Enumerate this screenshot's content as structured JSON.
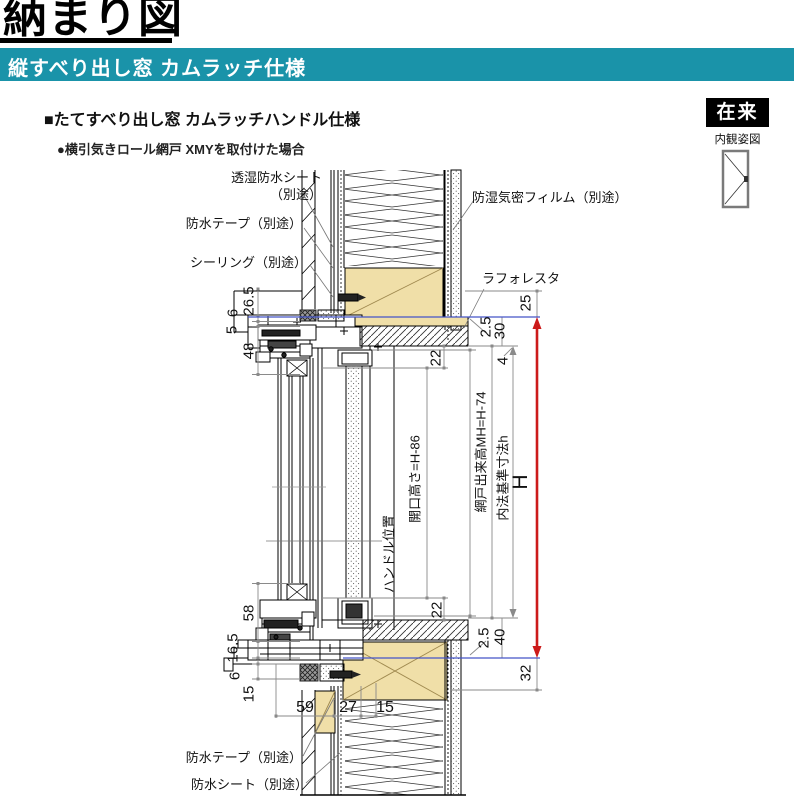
{
  "page": {
    "title": "納まり図",
    "band_title": "縦すべり出し窓 カムラッチ仕様",
    "section_heading": "■たてすべり出し窓 カムラッチハンドル仕様",
    "condition_note": "●横引気きロール網戸 XMYを取付けた場合",
    "construction_badge": "在来",
    "view_caption": "内観姿図"
  },
  "colors": {
    "band_teal": "#1a93a9",
    "wood_fill": "#f0dfa8",
    "reference_blue": "#4353c8",
    "dimension_red": "#cc1a1a"
  },
  "callouts": {
    "breathable_sheet": "透湿防水シート\n（別途）",
    "waterproof_tape_top": "防水テープ（別途）",
    "sealing": "シーリング（別途）",
    "vapor_film": "防湿気密フィルム（別途）",
    "laforesta": "ラフォレスタ",
    "waterproof_tape_bottom": "防水テープ（別途）",
    "waterproof_sheet_bottom": "防水シート（別途）"
  },
  "axis_labels": {
    "handle_position": "ハンドル位置",
    "opening_height": "開口高さ=H-86",
    "screen_height": "網戸出来高MH=H-74",
    "inner_standard": "内法基準寸法h",
    "overall_height": "H"
  },
  "dimensions": {
    "head_offset": "26.5",
    "head_gap": "6",
    "head_lip": "5",
    "head_frame": "48",
    "top_clearance": "25",
    "top_small": "2.5",
    "top_inner": "30",
    "top_step": "4",
    "opening_top": "22",
    "opening_bottom": "22",
    "sill_frame": "58",
    "sill_offset": "16.5",
    "sill_gap": "6",
    "sill_lower": "15",
    "bottom_small": "2.5",
    "bottom_inner": "40",
    "bottom_clearance": "32",
    "width_outer": "59",
    "width_mid": "27",
    "width_inner": "15"
  }
}
